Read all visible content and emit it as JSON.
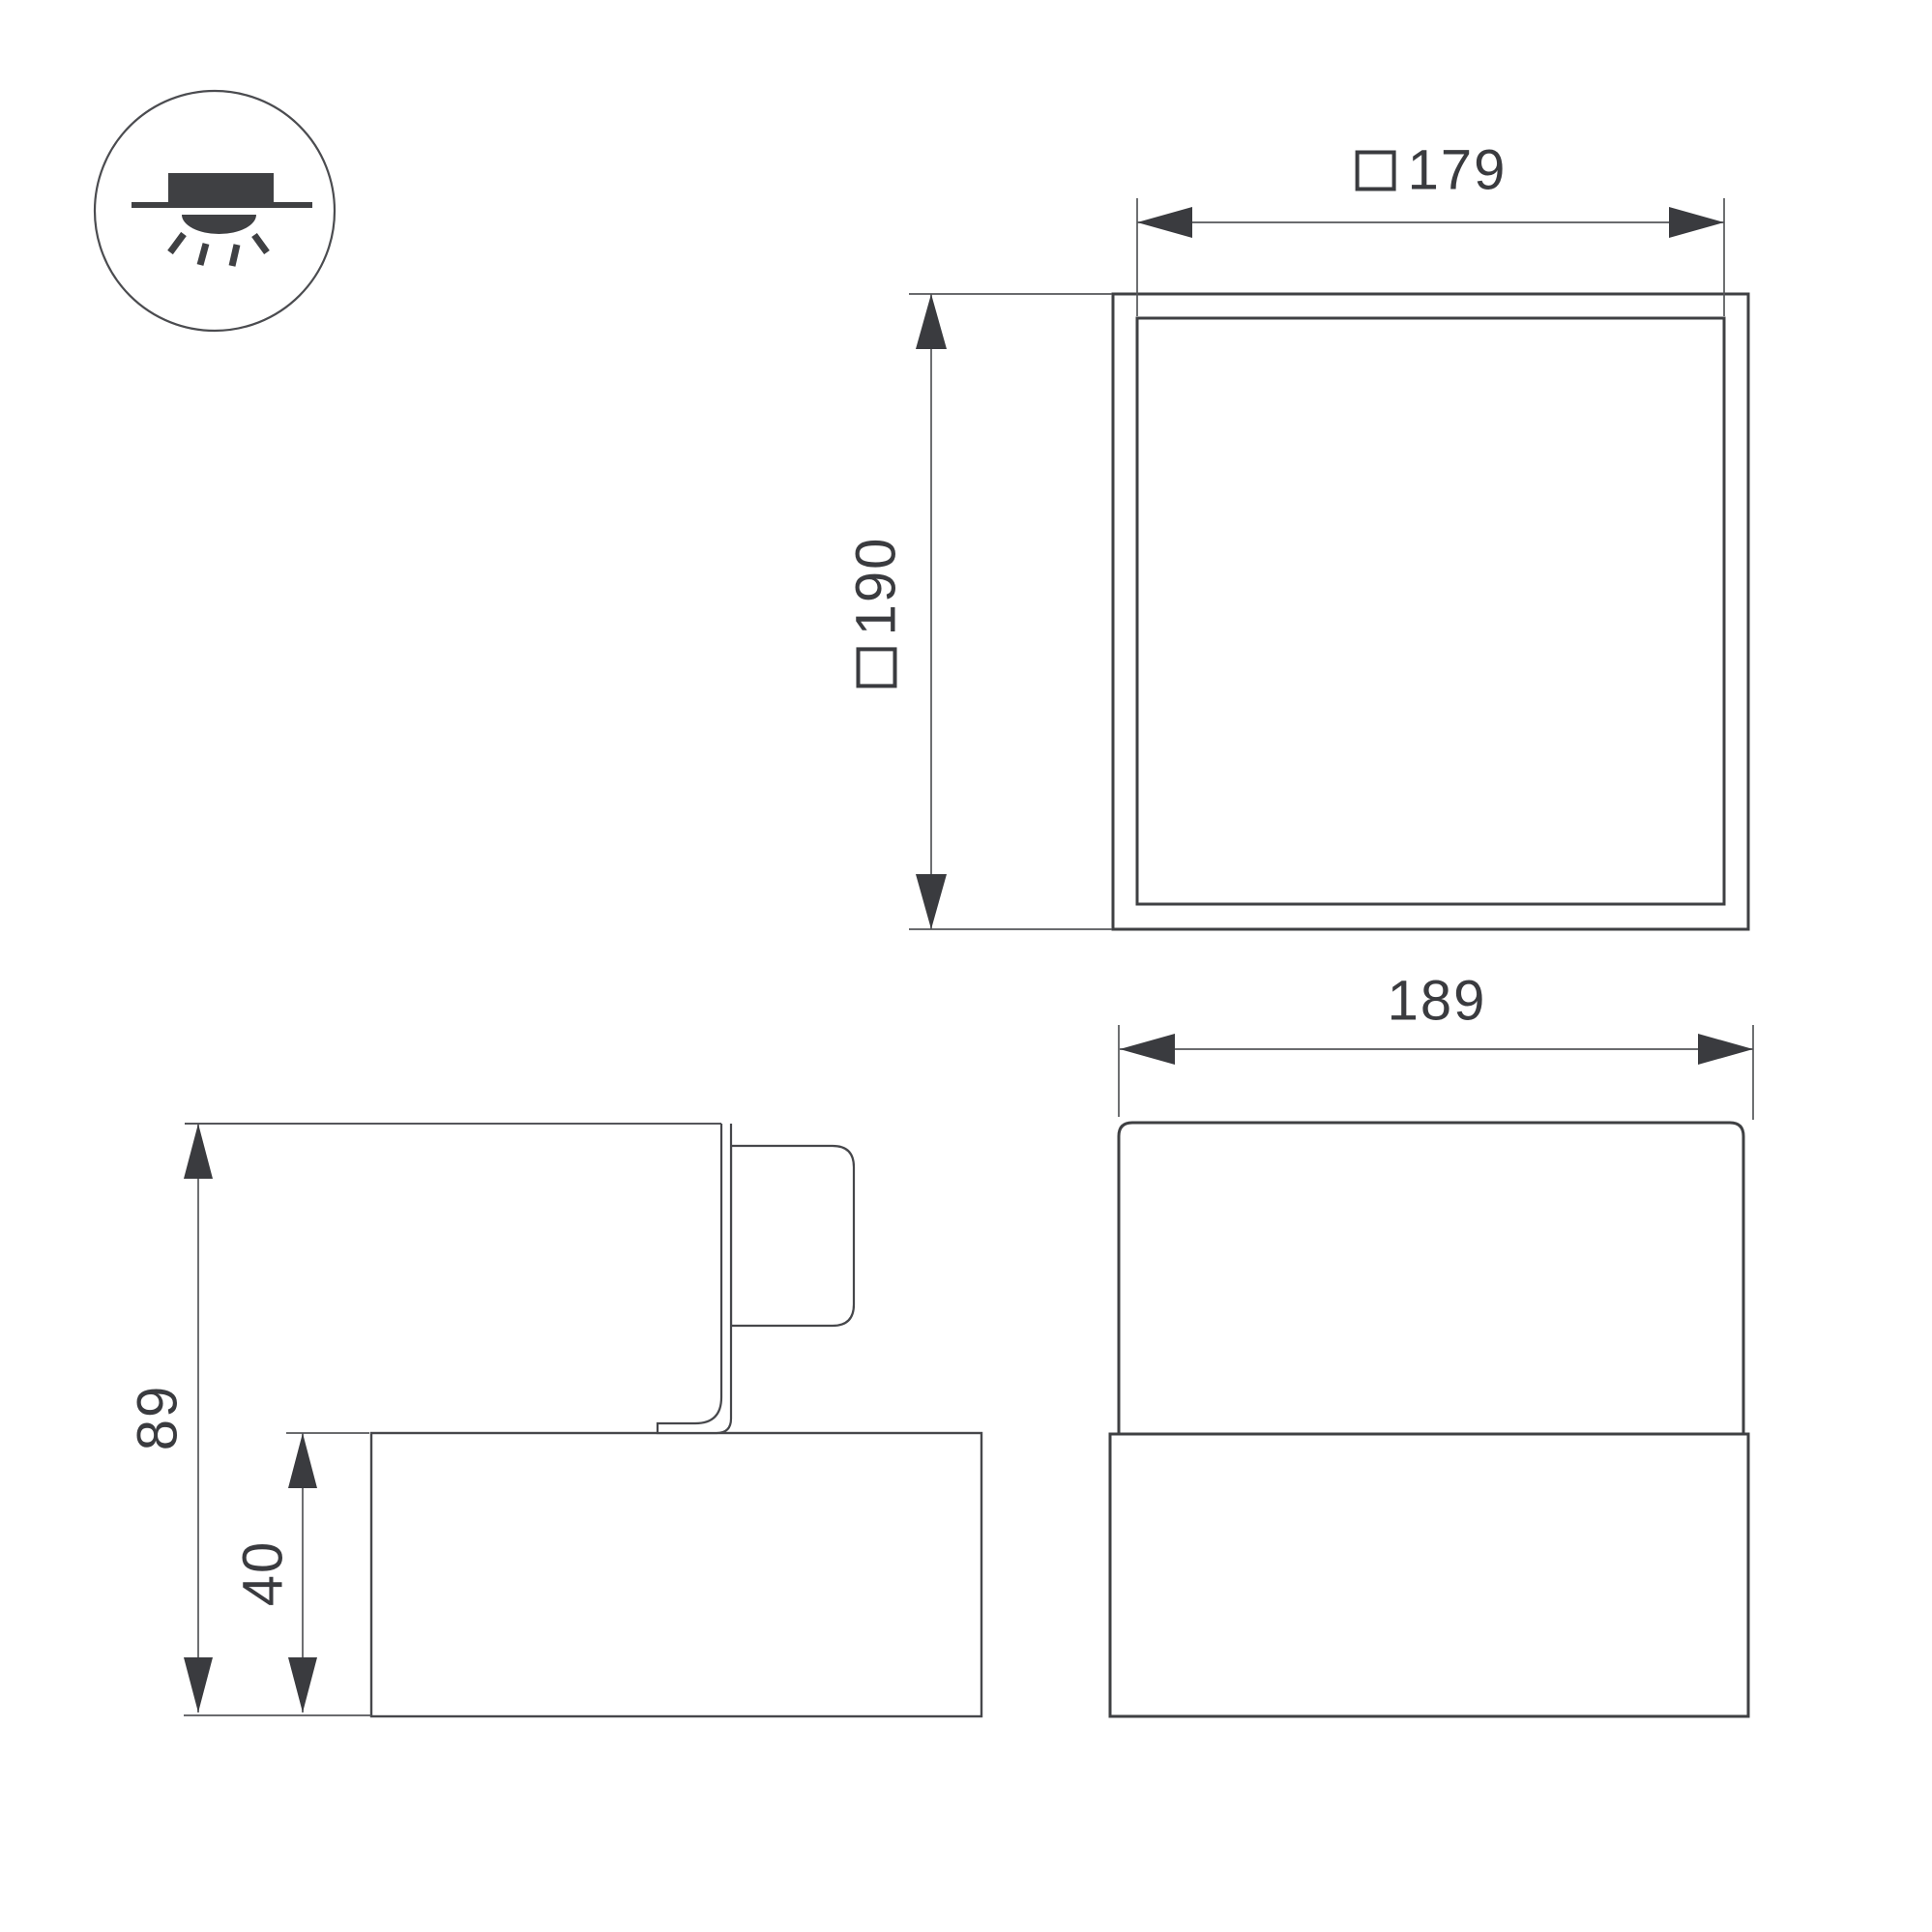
{
  "drawing": {
    "square_symbol": "□",
    "labels": {
      "cutout_size": "179",
      "overall_size": "190",
      "front_width": "189",
      "total_height": "89",
      "body_height": "40"
    },
    "icon": "surface-mounted-downlight-icon",
    "colors": {
      "outline": "#3f4043",
      "thin_line": "#55565a",
      "text": "#3a3b3f",
      "background": "#ffffff"
    }
  }
}
